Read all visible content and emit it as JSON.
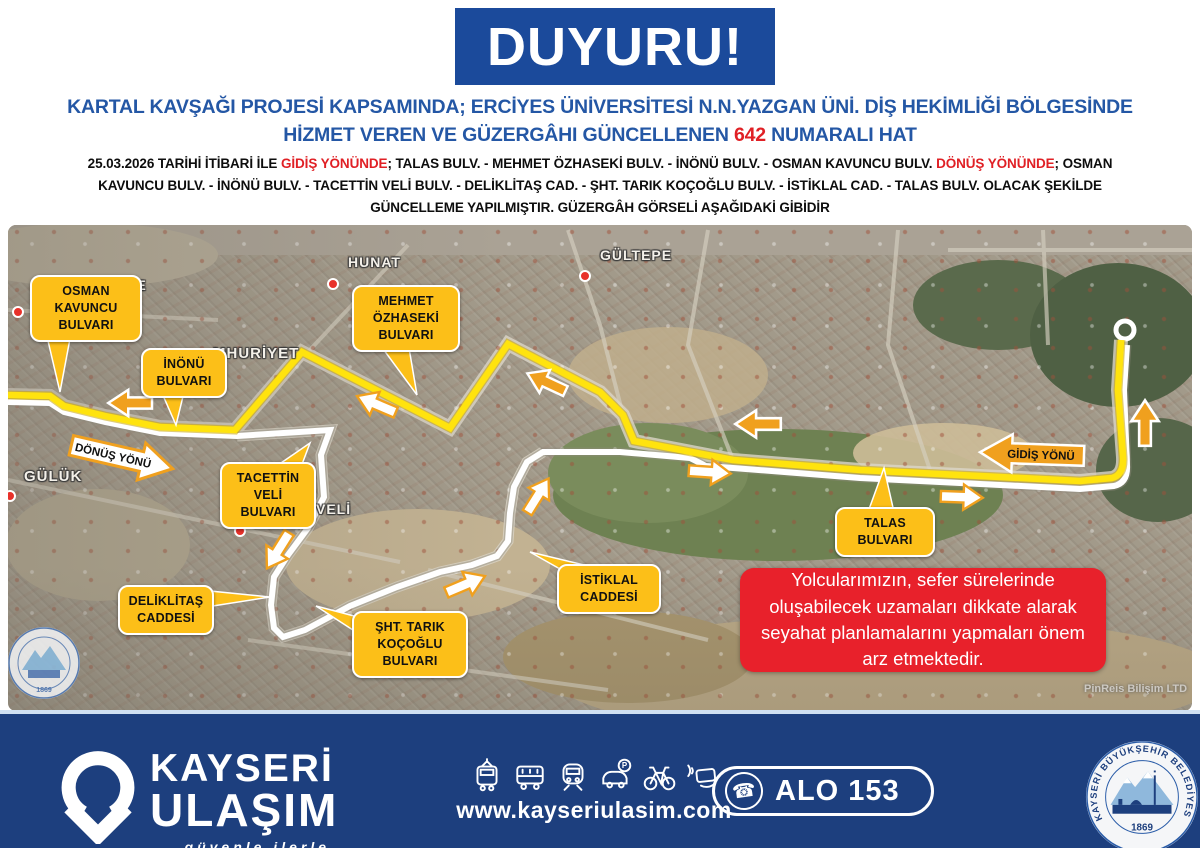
{
  "banner": {
    "text": "DUYURU!"
  },
  "title": {
    "part1": "KARTAL KAVŞAĞI PROJESİ KAPSAMINDA; ERCİYES ÜNİVERSİTESİ N.N.YAZGAN ÜNİ. DİŞ HEKİMLİĞİ BÖLGESİNDE HİZMET VEREN VE GÜZERGÂHI GÜNCELLENEN ",
    "number": "642",
    "part2": " NUMARALI HAT"
  },
  "body": {
    "seg1": "25.03.2026 TARİHİ İTİBARİ İLE ",
    "red1": "GİDİŞ YÖNÜNDE",
    "seg2": "; TALAS BULV. - MEHMET ÖZHASEKİ BULV. - İNÖNÜ BULV. - OSMAN KAVUNCU BULV. ",
    "red2": "DÖNÜŞ YÖNÜNDE",
    "seg3": "; OSMAN KAVUNCU BULV. - İNÖNÜ BULV. - TACETTİN VELİ BULV. - DELİKLİTAŞ CAD. - ŞHT. TARIK KOÇOĞLU BULV. - İSTİKLAL CAD. - TALAS BULV. OLACAK ŞEKİLDE GÜNCELLEME YAPILMIŞTIR. GÜZERGÂH GÖRSELİ AŞAĞIDAKİ GİBİDİR"
  },
  "map": {
    "callouts": [
      {
        "id": "osman-kavuncu",
        "label": "OSMAN KAVUNCU BULVARI"
      },
      {
        "id": "inonu",
        "label": "İNÖNÜ BULVARI"
      },
      {
        "id": "mehmet-ozhaseki",
        "label": "MEHMET ÖZHASEKİ BULVARI"
      },
      {
        "id": "tacettin-veli",
        "label": "TACETTİN VELİ BULVARI"
      },
      {
        "id": "deliklitas",
        "label": "DELİKLİTAŞ CADDESİ"
      },
      {
        "id": "sht-tarik-kocoglu",
        "label": "ŞHT. TARIK KOÇOĞLU BULVARI"
      },
      {
        "id": "istiklal",
        "label": "İSTİKLAL CADDESİ"
      },
      {
        "id": "talas",
        "label": "TALAS BULVARI"
      }
    ],
    "direction_arrows": {
      "donus": "DÖNÜŞ YÖNÜ",
      "gidis": "GİDİŞ YÖNÜ"
    },
    "place_labels": [
      "SİBE",
      "HUNAT",
      "GÜLTEPE",
      "MHURİYET",
      "GÜLÜK",
      "İNVELİ"
    ],
    "advisory": "Yolcularımızın, sefer sürelerinde oluşabilecek uzamaları dikkate alarak seyahat planlamalarını yapmaları önem arz etmektedir.",
    "credit": "PinReis Bilişim LTD"
  },
  "footer": {
    "brand_line1": "KAYSERİ",
    "brand_line2": "ULAŞIM",
    "tagline": "güvenle ilerle",
    "website": "www.kayseriulasim.com",
    "phone_label": "ALO 153",
    "phone_icon": "phone-handset-icon",
    "icons": [
      "tram",
      "bus",
      "metro",
      "car-parking",
      "bicycle",
      "contactless-card"
    ],
    "seal_text": "KAYSERİ BÜYÜKŞEHİR BELEDİYESİ",
    "seal_year": "1869"
  },
  "colors": {
    "banner_blue": "#1b4a9b",
    "title_blue": "#2457a5",
    "highlight_red": "#e02025",
    "advisory_red": "#e8212b",
    "callout_yellow": "#fcbf18",
    "route_yellow": "#ffe30e",
    "route_white": "#ffffff",
    "arrow_orange": "#f0a01e",
    "footer_navy": "#1d3f7e"
  }
}
